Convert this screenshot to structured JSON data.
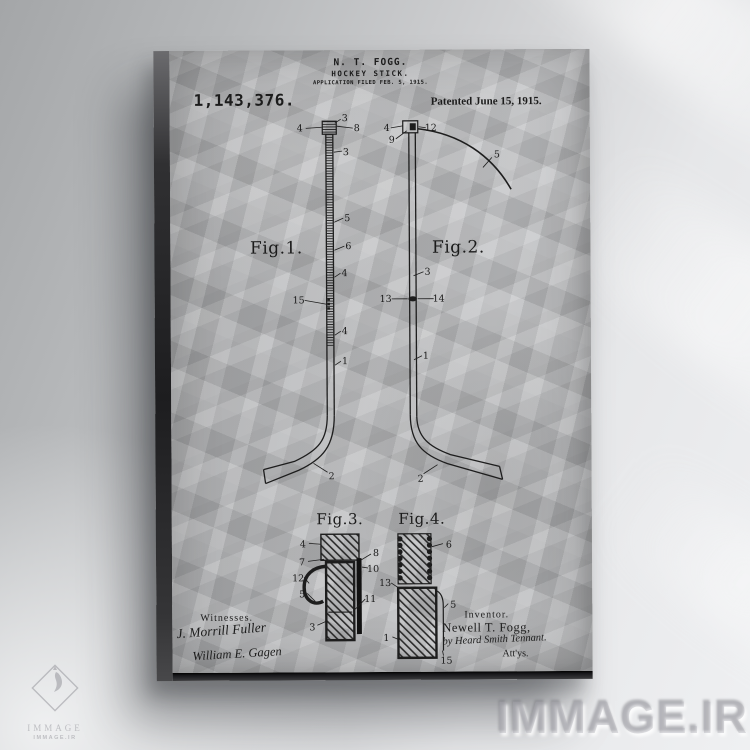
{
  "palette": {
    "wall_light": "#eff0f2",
    "wall_dark": "#a4a6a8",
    "paper": "#b5b6b8",
    "ink": "#1c1c1c",
    "canvas_edge": "#1d1d1f",
    "watermark": "#adadb3"
  },
  "patent": {
    "header": {
      "inventor_line": "N. T. FOGG.",
      "title_line": "HOCKEY STICK.",
      "application_line": "APPLICATION FILED FEB. 5, 1915.",
      "patent_number": "1,143,376.",
      "patented_line": "Patented June 15, 1915."
    },
    "figures": {
      "fig1": {
        "caption": "Fig.1.",
        "labels": [
          "3",
          "4",
          "8",
          "3",
          "5",
          "6",
          "4",
          "15",
          "4",
          "1",
          "2"
        ]
      },
      "fig2": {
        "caption": "Fig.2.",
        "labels": [
          "4",
          "9",
          "12",
          "5",
          "3",
          "13",
          "14",
          "1",
          "2"
        ]
      },
      "fig3": {
        "caption": "Fig.3.",
        "labels": [
          "4",
          "7",
          "12",
          "5",
          "8",
          "10",
          "11",
          "3"
        ]
      },
      "fig4": {
        "caption": "Fig.4.",
        "labels": [
          "6",
          "13",
          "5",
          "1",
          "15"
        ]
      }
    },
    "footer": {
      "witnesses_heading": "Witnesses.",
      "witness_signature_1": "J. Morrill Fuller",
      "witness_signature_2": "William E. Gagen",
      "inventor_heading": "Inventor.",
      "inventor_name": "Newell T. Fogg,",
      "attorney_line": "by Heard Smith Tennant.",
      "attorneys_suffix": "Att'ys."
    }
  },
  "branding": {
    "watermark_large": "IMMAGE.IR",
    "logo_name": "IMMAGE",
    "logo_site": "IMMAGE.IR"
  }
}
